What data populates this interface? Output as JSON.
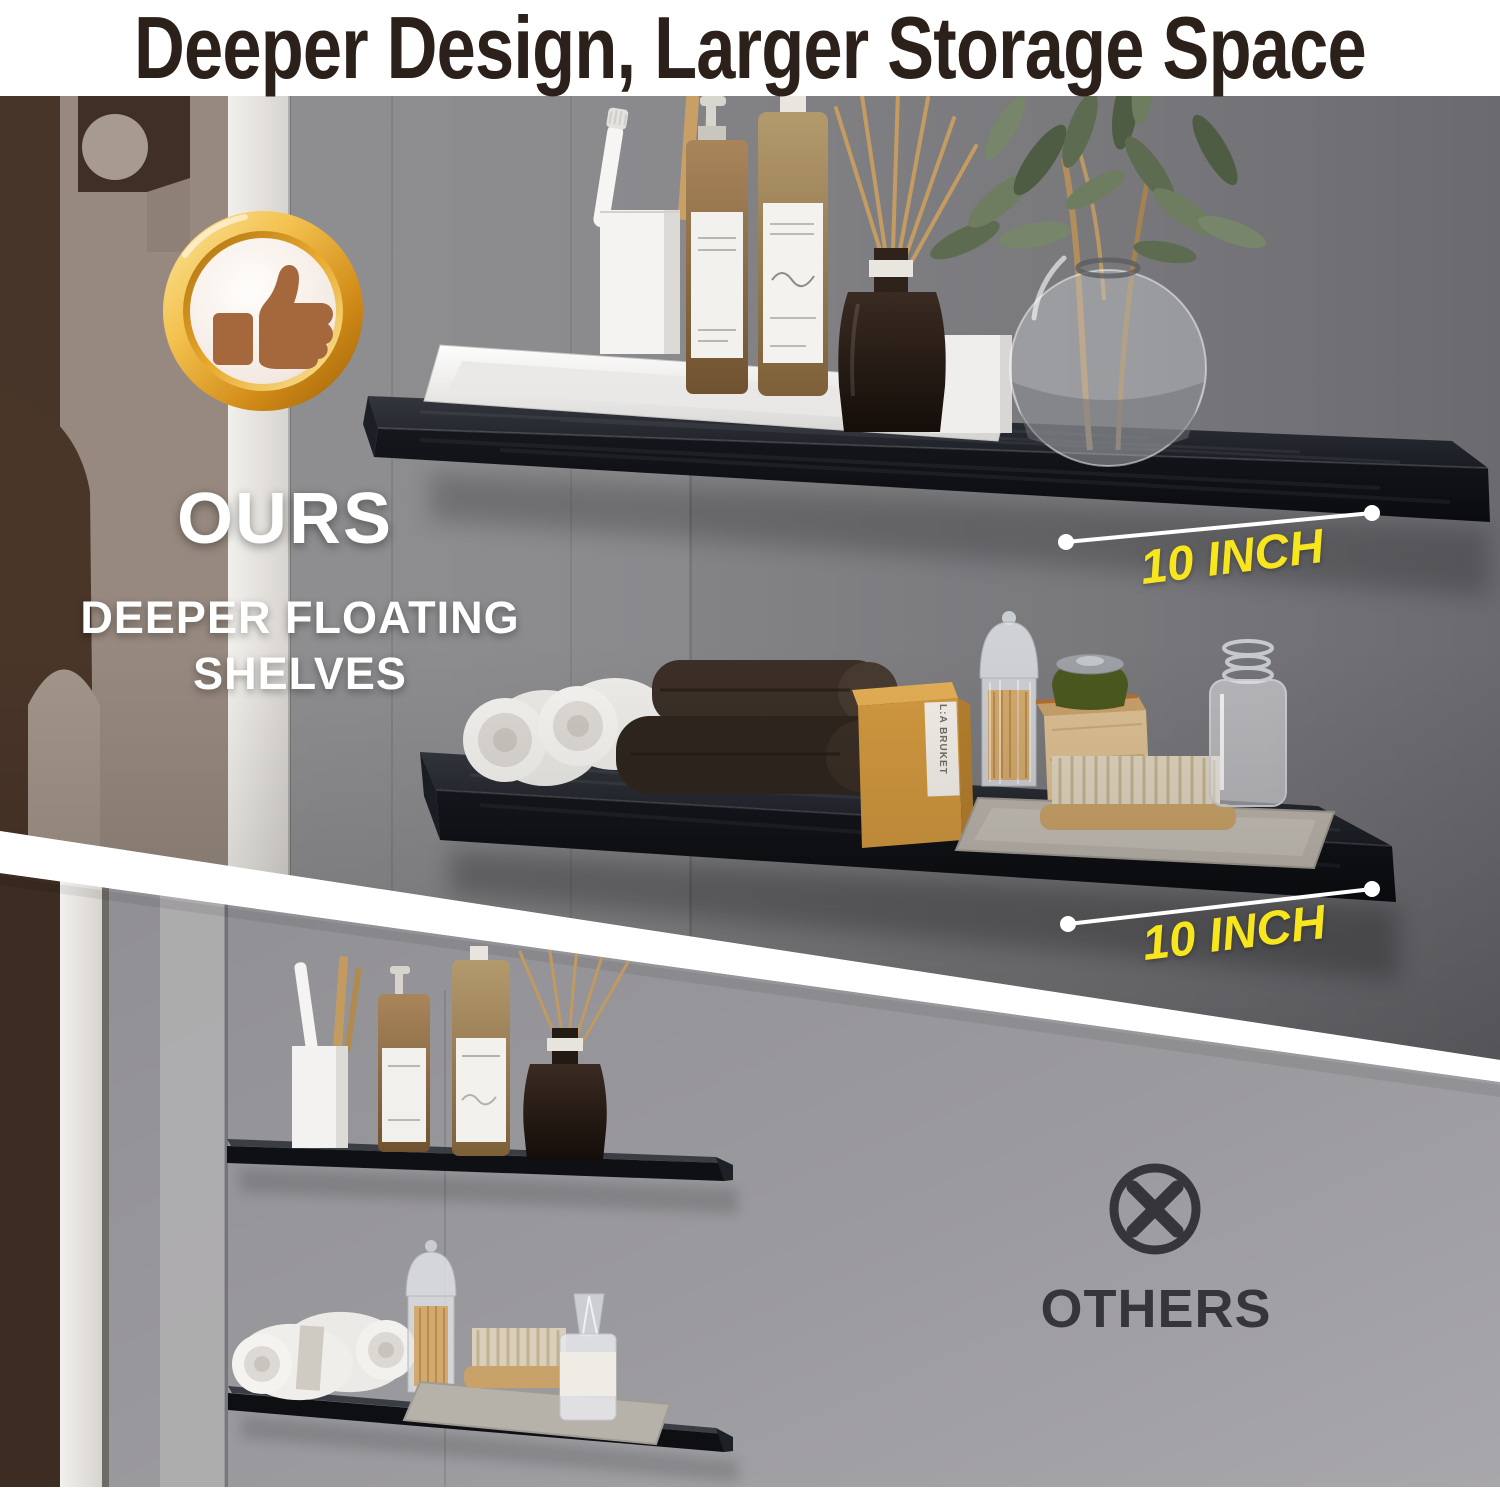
{
  "title": "Deeper Design, Larger Storage Space",
  "ours_section": {
    "badge_icon": "thumbs-up-gold-medal",
    "label": "OURS",
    "subtitle_line1": "DEEPER FLOATING",
    "subtitle_line2": "SHELVES",
    "shelf_depth_top": "10 INCH",
    "shelf_depth_bottom": "10 INCH",
    "product_box_label": "L:A BRUKET"
  },
  "others_section": {
    "icon": "crossed-circle",
    "label": "OTHERS"
  },
  "colors": {
    "accent_yellow": "#F7E51D",
    "badge_gold": "#E9A62B",
    "title_text": "#2B211A",
    "white_text": "#FFFFFF",
    "others_text": "#35353A",
    "shelf_black": "#13151A",
    "wall_gray_ours": "#8A8A8D",
    "wall_gray_others": "#9B9A9E",
    "divider_white": "#FFFFFF"
  }
}
